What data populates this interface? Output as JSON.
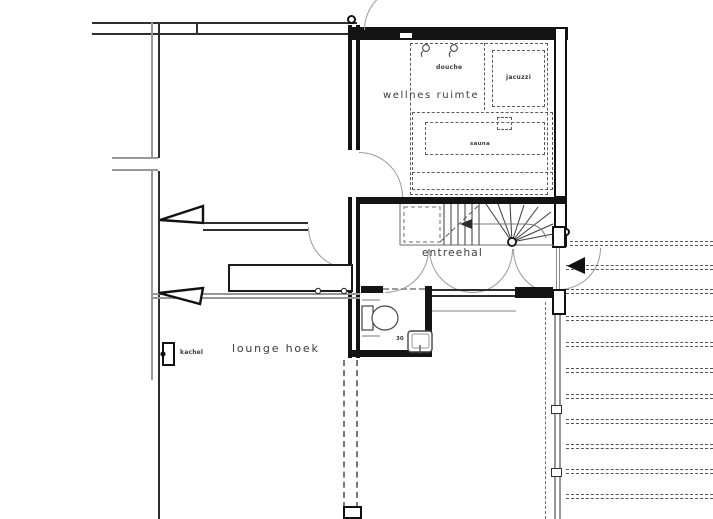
{
  "drawing": {
    "type": "architectural floor plan (ground floor with wellness area)",
    "labels": {
      "wellness_room": "wellnes ruimte",
      "shower": "douche",
      "jacuzzi": "jacuzzi",
      "sauna": "sauna",
      "entrance_hall": "entreehal",
      "lounge": "lounge hoek",
      "stove": "kachel",
      "dimension_30": "30"
    },
    "symbols": [
      "shower-head-icon",
      "toilet-symbol",
      "sink-symbol",
      "stove-symbol",
      "winder-stair",
      "door-swing-arc",
      "entrance-arrow",
      "decking-lines",
      "sliding-panel-triangle",
      "counter-with-hobs",
      "column"
    ],
    "colors": {
      "line": "#141414",
      "secondary_line": "#979797",
      "dashed_line": "#5c5c5c",
      "background": "#ffffff"
    }
  }
}
